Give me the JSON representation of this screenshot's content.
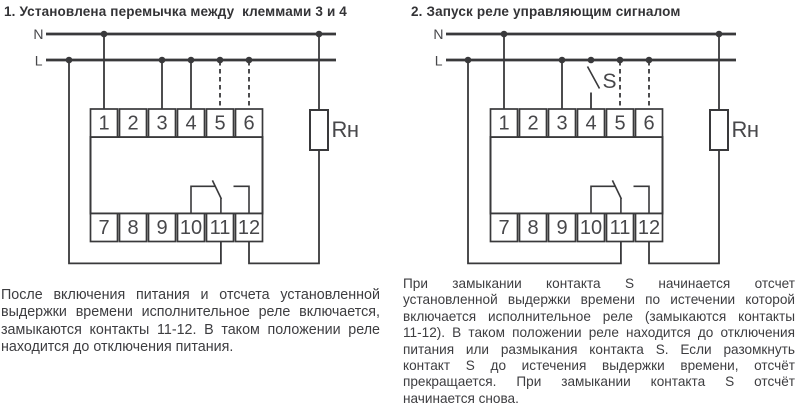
{
  "ui": {
    "background": "#ffffff",
    "ink_color": "#39393b",
    "text_color": "#3d3d40"
  },
  "diagram1": {
    "title": "1. Установлена перемычка между  клеммами 3 и 4",
    "neutral_label": "N",
    "line_label": "L",
    "load_label": "Rн",
    "terminals_top": [
      "1",
      "2",
      "3",
      "4",
      "5",
      "6"
    ],
    "terminals_bottom": [
      "7",
      "8",
      "9",
      "10",
      "11",
      "12"
    ],
    "description_lines": [
      "После включения питания и отсчета установленной",
      "выдержки времени исполнительное реле включается,",
      "замыкаются контакты 11-12. В таком положении реле",
      "находится до отключения питания."
    ]
  },
  "diagram2": {
    "title": "2. Запуск реле управляющим сигналом",
    "neutral_label": "N",
    "line_label": "L",
    "switch_label": "S",
    "load_label": "Rн",
    "terminals_top": [
      "1",
      "2",
      "3",
      "4",
      "5",
      "6"
    ],
    "terminals_bottom": [
      "7",
      "8",
      "9",
      "10",
      "11",
      "12"
    ],
    "description_lines": [
      "При замыкании контакта S начинается отсчет",
      "установленной выдержки времени по истечении которой",
      "включается исполнительное реле (замыкаются контакты",
      "11-12). В таком положении реле находится до отключения",
      "питания или размыкания контакта S. Если разомкнуть",
      "контакт S до истечения выдержки времени, отсчёт",
      "прекращается. При замыкании контакта S отсчёт",
      "начинается снова."
    ]
  }
}
